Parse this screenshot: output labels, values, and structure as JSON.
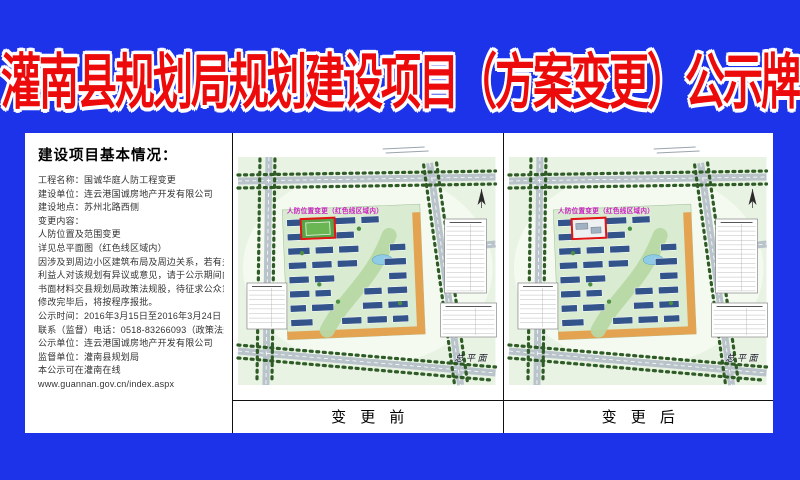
{
  "title": {
    "text": "灌南县规划局规划建设项目（方案变更）公示牌",
    "color": "#ec0a0a",
    "outline": "#ffffff"
  },
  "info_panel": {
    "heading": "建设项目基本情况：",
    "lines": [
      "工程名称：国诚华庭人防工程变更",
      "建设单位：连云港国诚房地产开发有限公司",
      "建设地点：苏州北路西侧",
      "变更内容：",
      "人防位置及范围变更",
      "详见总平面图（红色线区域内）",
      "因涉及到周边小区建筑布局及周边关系，若有关",
      "利益人对该规划有异议或意见，请于公示期间内将",
      "书面材料交县规划局政策法规股，待征求公众意见",
      "修改完毕后，将按程序报批。",
      "公示时间：2016年3月15日至2016年3月24日",
      "联系（监督）电话：0518-83266093（政策法规股）",
      "公示单位：连云港国诚房地产开发有限公司",
      "监督单位：灌南县规划局",
      "本公示可在灌南在线",
      "www.guannan.gov.cn/index.aspx"
    ]
  },
  "maps": {
    "before": {
      "label": "变 更 前",
      "annotation": "人防位置变更（红色线区域内）",
      "plan_caption": "总平面",
      "highlight_fill": "#57a447"
    },
    "after": {
      "label": "变 更 后",
      "annotation": "人防位置变更（红色线区域内）",
      "plan_caption": "总平面",
      "highlight_fill": "#eef1f2"
    }
  },
  "colors": {
    "background": "#1c33e9",
    "highlight_red": "#e21414",
    "map_bg": "#e9f3e3",
    "road": "#b9c3ca",
    "tree": "#2e5b26",
    "building": "#33538b",
    "orange_strip": "#e4a351",
    "pond": "#8ecbe4",
    "annotation_magenta": "#cf1ec4"
  }
}
